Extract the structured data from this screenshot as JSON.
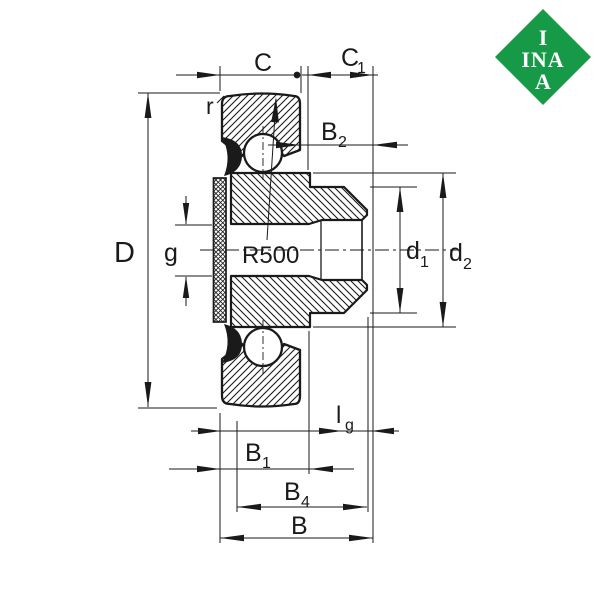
{
  "drawing": {
    "type": "bearing-unit cross-section dimension drawing",
    "line_color": "#1a1a1a",
    "background": "#ffffff",
    "labels": {
      "C": "C",
      "C1_main": "C",
      "C1_sub": "1",
      "r": "r",
      "B2_main": "B",
      "B2_sub": "2",
      "D": "D",
      "g": "g",
      "R500": "R500",
      "d1_main": "d",
      "d1_sub": "1",
      "d2_main": "d",
      "d2_sub": "2",
      "lg_main": "l",
      "lg_sub": "g",
      "B1_main": "B",
      "B1_sub": "1",
      "B4_main": "B",
      "B4_sub": "4",
      "B": "B"
    }
  },
  "logo": {
    "color": "#179a47",
    "row1": "I",
    "row2": "INA",
    "row3": "A"
  }
}
